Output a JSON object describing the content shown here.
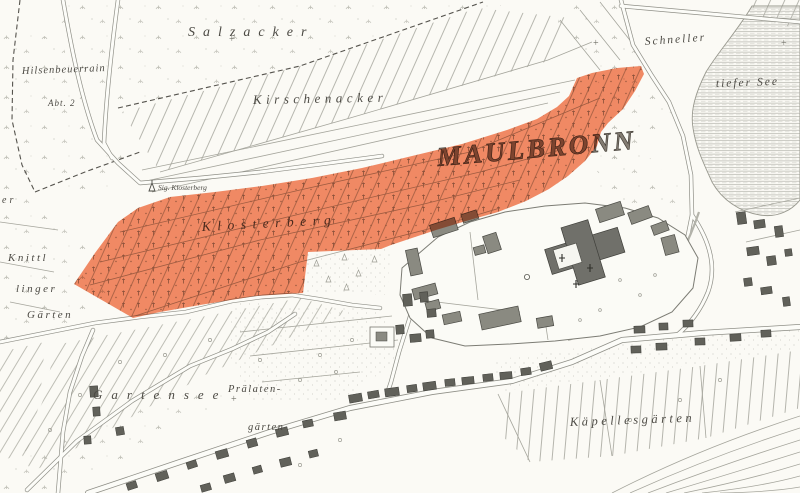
{
  "map": {
    "place_label": "MAULBRONN",
    "region_labels": {
      "salzacker": "Salzacker",
      "hilsenbeuerrain": "Hilsenbeuerrain",
      "abt2": "Abt. 2",
      "kirschenacker": "Kirschenacker",
      "schneller": "Schneller",
      "tiefer_see": "tiefer See",
      "klosterberg": "Klosterberg",
      "knittl_line1": "Knittl",
      "knittl_line2": "linger",
      "knittl_line3": "Gärten",
      "er_fragment": "er",
      "gartensee": "Gartensee",
      "praelaten_line1": "Prälaten-",
      "praelaten_line2": "gärten",
      "kaepellesgaerten": "Käpellesgärten"
    },
    "point_labels": {
      "sig_klosterberg": "Sig. Klosterberg"
    },
    "symbols": {
      "survey_cross": "+"
    },
    "highlight": {
      "name": "Klosterberg vineyard highlight",
      "color": "#f3855f",
      "blend": "multiply"
    },
    "palette": {
      "paper": "#fbfaf5",
      "ink": "#8c8c84",
      "label_ink": "#4c4a44"
    }
  }
}
